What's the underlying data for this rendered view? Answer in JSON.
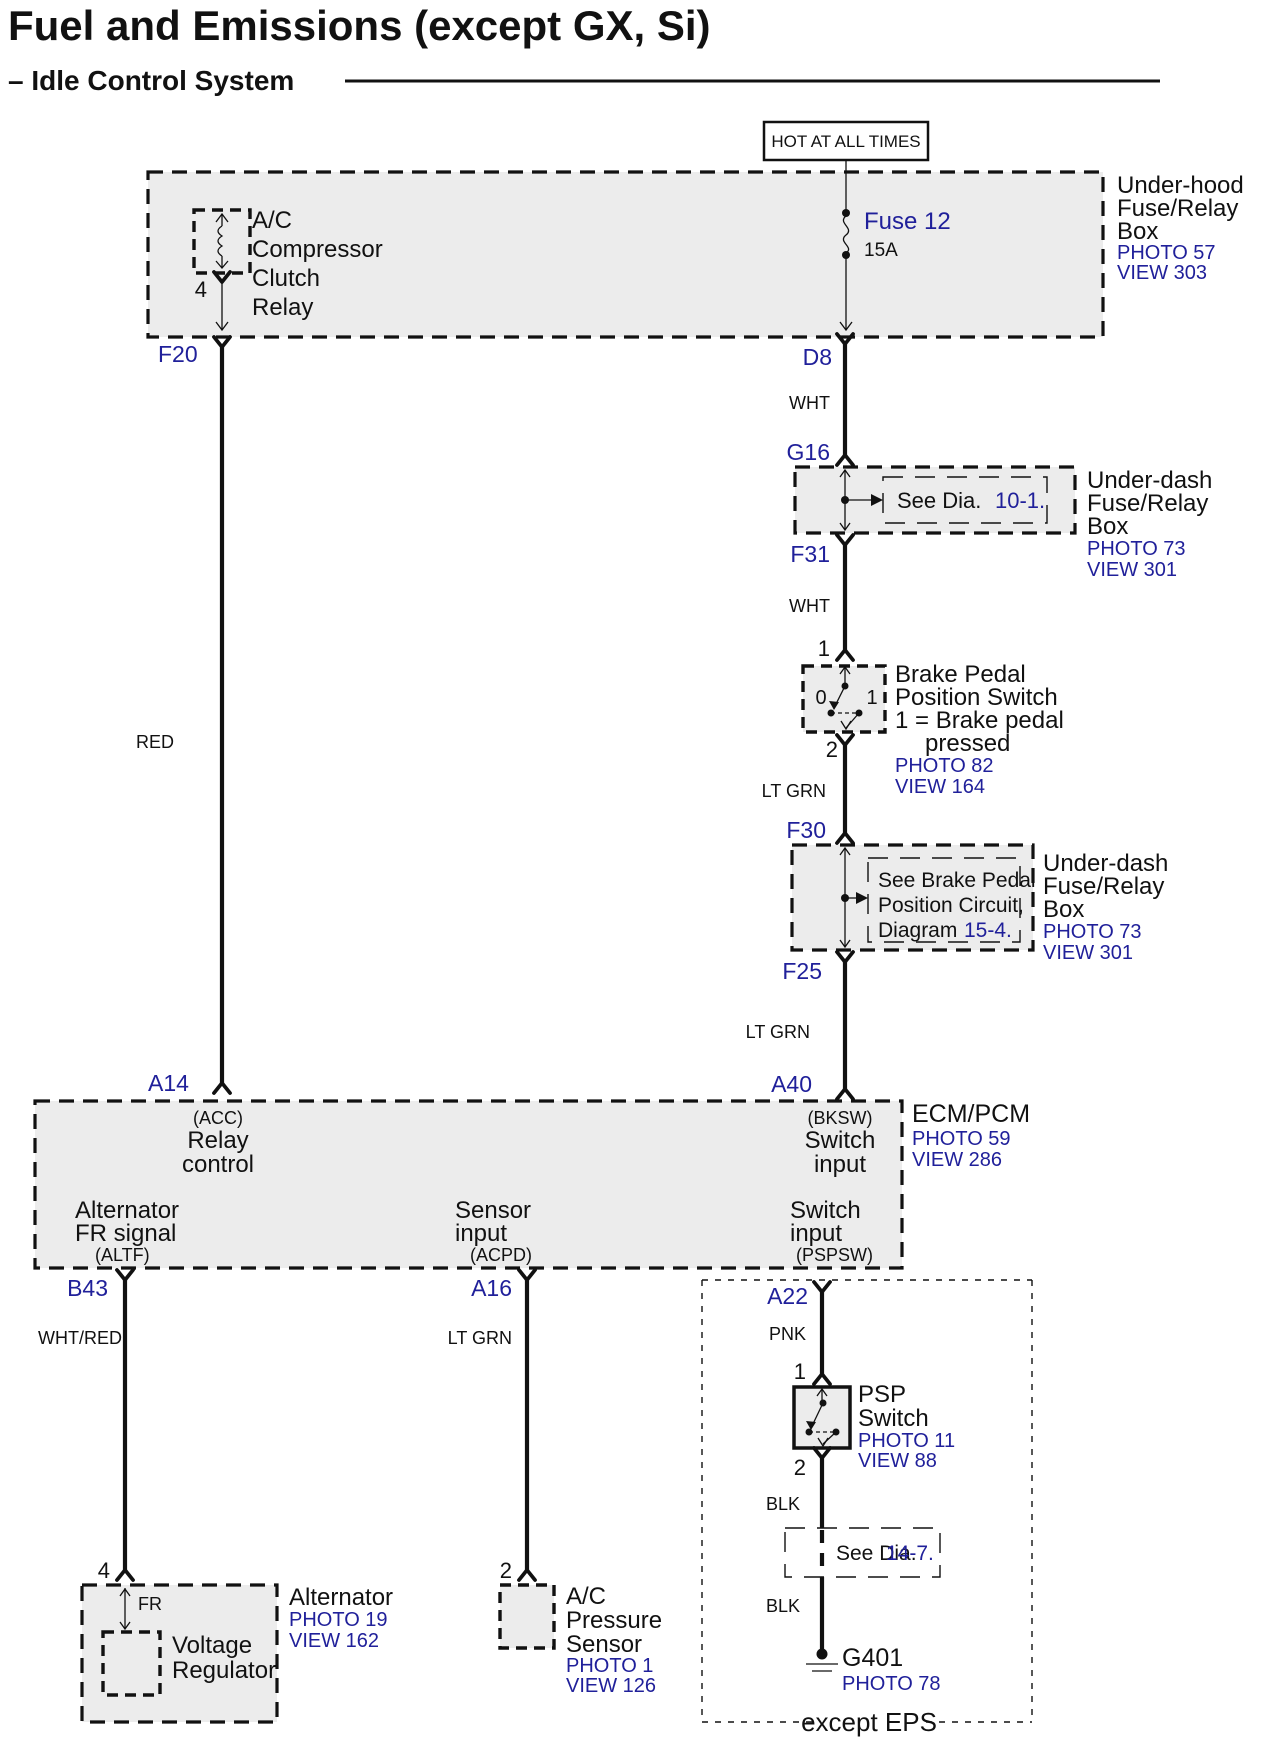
{
  "header": {
    "title": "Fuel and Emissions (except GX, Si)",
    "subtitle": "– Idle Control System"
  },
  "banner": {
    "label": "HOT AT ALL TIMES"
  },
  "colors": {
    "accent_blue": "#20209a",
    "diagram_black": "#111111",
    "box_fill": "#ececec"
  },
  "underhood": {
    "l1": "Under-hood",
    "l2": "Fuse/Relay",
    "l3": "Box",
    "photo": "PHOTO 57",
    "view": "VIEW 303"
  },
  "relay": {
    "l1": "A/C",
    "l2": "Compressor",
    "l3": "Clutch",
    "l4": "Relay",
    "pin": "4"
  },
  "fuse": {
    "name": "Fuse 12",
    "rating": "15A"
  },
  "terminals": {
    "f20": "F20",
    "d8": "D8",
    "g16": "G16",
    "f31": "F31",
    "f30": "F30",
    "f25": "F25",
    "a14": "A14",
    "a40": "A40",
    "b43": "B43",
    "a16": "A16",
    "a22": "A22"
  },
  "wires": {
    "red": "RED",
    "wht1": "WHT",
    "wht2": "WHT",
    "ltgrn1": "LT GRN",
    "ltgrn2": "LT GRN",
    "whtred": "WHT/RED",
    "ltgrn3": "LT GRN",
    "pnk": "PNK",
    "blk1": "BLK",
    "blk2": "BLK"
  },
  "underdash1": {
    "see": "See  Dia.",
    "ref": "10-1.",
    "l1": "Under-dash",
    "l2": "Fuse/Relay",
    "l3": "Box",
    "photo": "PHOTO 73",
    "view": "VIEW 301"
  },
  "brake_switch": {
    "pin_top": "1",
    "pin_bottom": "2",
    "pos0": "0",
    "pos1": "1",
    "l1": "Brake Pedal",
    "l2": "Position Switch",
    "l3": "1 = Brake pedal",
    "l4": "pressed",
    "photo": "PHOTO 82",
    "view": "VIEW 164"
  },
  "underdash2": {
    "see1": "See Brake Pedal",
    "see2": "Position Circuit,",
    "see3": "Diagram",
    "ref": "15-4.",
    "l1": "Under-dash",
    "l2": "Fuse/Relay",
    "l3": "Box",
    "photo": "PHOTO 73",
    "view": "VIEW 301"
  },
  "ecm": {
    "name": "ECM/PCM",
    "photo": "PHOTO 59",
    "view": "VIEW 286",
    "pin_a14": {
      "sub": "(ACC)",
      "l1": "Relay",
      "l2": "control"
    },
    "pin_a40": {
      "sub": "(BKSW)",
      "l1": "Switch",
      "l2": "input"
    },
    "pin_b43": {
      "l1": "Alternator",
      "l2": "FR signal",
      "sub": "(ALTF)"
    },
    "pin_a16": {
      "l1": "Sensor",
      "l2": "input",
      "sub": "(ACPD)"
    },
    "pin_a22": {
      "l1": "Switch",
      "l2": "input",
      "sub": "(PSPSW)"
    }
  },
  "psp": {
    "pin_top": "1",
    "pin_bottom": "2",
    "l1": "PSP",
    "l2": "Switch",
    "photo": "PHOTO 11",
    "view": "VIEW 88"
  },
  "see147": {
    "see": "See Dia.",
    "ref": "14-7."
  },
  "ground": {
    "name": "G401",
    "photo": "PHOTO 78"
  },
  "eps": {
    "label": "except EPS"
  },
  "alternator": {
    "pin": "4",
    "fr": "FR",
    "vr1": "Voltage",
    "vr2": "Regulator",
    "name": "Alternator",
    "photo": "PHOTO 19",
    "view": "VIEW 162"
  },
  "ac_sensor": {
    "pin": "2",
    "l1": "A/C",
    "l2": "Pressure",
    "l3": "Sensor",
    "photo": "PHOTO 1",
    "view": "VIEW 126"
  }
}
